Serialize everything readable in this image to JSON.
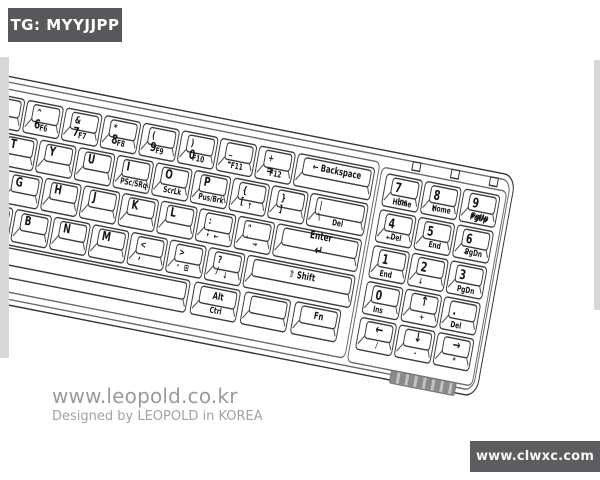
{
  "badge": {
    "text": "TG: MYYJJPP"
  },
  "watermark": {
    "line1": "www.leopold.co.kr",
    "line2": "Designed by LEOPOLD in KOREA"
  },
  "footer_badge": {
    "text": "www.clwxc.com"
  },
  "colors": {
    "badge_bg": "#58585a",
    "footer_bg": "#5d5d5f",
    "line": "#3c3c3c",
    "muted_text": "#9a9a9a"
  },
  "keyboard": {
    "main_keys": [
      {
        "id": "5",
        "x": 214,
        "y": 36,
        "w": 38,
        "h": 24,
        "label": "%\n5",
        "front": "F5",
        "cls": "num"
      },
      {
        "id": "6",
        "x": 254,
        "y": 36,
        "w": 38,
        "h": 24,
        "label": "^\n6",
        "front": "F6",
        "cls": "num"
      },
      {
        "id": "7",
        "x": 294,
        "y": 36,
        "w": 38,
        "h": 24,
        "label": "&\n7",
        "front": "F7",
        "cls": "num"
      },
      {
        "id": "8",
        "x": 334,
        "y": 36,
        "w": 38,
        "h": 24,
        "label": "*\n8",
        "front": "F8",
        "cls": "num"
      },
      {
        "id": "9",
        "x": 374,
        "y": 36,
        "w": 38,
        "h": 24,
        "label": "(\n9",
        "front": "F9",
        "cls": "num"
      },
      {
        "id": "0",
        "x": 414,
        "y": 36,
        "w": 38,
        "h": 24,
        "label": ")\n0",
        "front": "F10",
        "cls": "num"
      },
      {
        "id": "minus",
        "x": 454,
        "y": 36,
        "w": 38,
        "h": 24,
        "label": "_\n-",
        "front": "F11",
        "cls": "num"
      },
      {
        "id": "equals",
        "x": 494,
        "y": 36,
        "w": 38,
        "h": 24,
        "label": "+\n=",
        "front": "F12",
        "cls": "num"
      },
      {
        "id": "backspace",
        "x": 534,
        "y": 36,
        "w": 80,
        "h": 24,
        "label": "← Backspace",
        "cls": "mod"
      },
      {
        "id": "r",
        "x": 194,
        "y": 62,
        "w": 38,
        "h": 24,
        "label": "R",
        "cls": "ltr"
      },
      {
        "id": "t",
        "x": 234,
        "y": 62,
        "w": 38,
        "h": 24,
        "label": "T",
        "cls": "ltr"
      },
      {
        "id": "y",
        "x": 274,
        "y": 62,
        "w": 38,
        "h": 24,
        "label": "Y",
        "cls": "ltr"
      },
      {
        "id": "u",
        "x": 314,
        "y": 62,
        "w": 38,
        "h": 24,
        "label": "U",
        "cls": "ltr"
      },
      {
        "id": "i",
        "x": 354,
        "y": 62,
        "w": 38,
        "h": 24,
        "label": "I",
        "front": "PSc/SRq",
        "cls": "ltr"
      },
      {
        "id": "o",
        "x": 394,
        "y": 62,
        "w": 38,
        "h": 24,
        "label": "O",
        "front": "ScrLk",
        "cls": "ltr"
      },
      {
        "id": "p",
        "x": 434,
        "y": 62,
        "w": 38,
        "h": 24,
        "label": "P",
        "front": "Pus/Brk",
        "cls": "ltr"
      },
      {
        "id": "bracket-open",
        "x": 474,
        "y": 62,
        "w": 38,
        "h": 24,
        "label": "{\n[",
        "front": "↑",
        "cls": "sym"
      },
      {
        "id": "bracket-close",
        "x": 514,
        "y": 62,
        "w": 38,
        "h": 24,
        "label": "}\n]",
        "cls": "sym"
      },
      {
        "id": "backslash",
        "x": 554,
        "y": 62,
        "w": 60,
        "h": 24,
        "label": "|\n\\",
        "front": "Del",
        "cls": "sym"
      },
      {
        "id": "f",
        "x": 206,
        "y": 88,
        "w": 38,
        "h": 24,
        "label": "F",
        "cls": "ltr"
      },
      {
        "id": "g",
        "x": 246,
        "y": 88,
        "w": 38,
        "h": 24,
        "label": "G",
        "cls": "ltr"
      },
      {
        "id": "h",
        "x": 286,
        "y": 88,
        "w": 38,
        "h": 24,
        "label": "H",
        "cls": "ltr"
      },
      {
        "id": "j",
        "x": 326,
        "y": 88,
        "w": 38,
        "h": 24,
        "label": "J",
        "cls": "ltr"
      },
      {
        "id": "k",
        "x": 366,
        "y": 88,
        "w": 38,
        "h": 24,
        "label": "K",
        "cls": "ltr"
      },
      {
        "id": "l",
        "x": 406,
        "y": 88,
        "w": 38,
        "h": 24,
        "label": "L",
        "cls": "ltr"
      },
      {
        "id": "semicolon",
        "x": 446,
        "y": 88,
        "w": 38,
        "h": 24,
        "label": ":\n;",
        "front": "←",
        "cls": "sym"
      },
      {
        "id": "quote",
        "x": 486,
        "y": 88,
        "w": 38,
        "h": 24,
        "label": "\"\n'",
        "front": "→",
        "cls": "sym"
      },
      {
        "id": "enter",
        "x": 526,
        "y": 88,
        "w": 88,
        "h": 24,
        "label": "Enter\n↵",
        "cls": "enter"
      },
      {
        "id": "v",
        "x": 222,
        "y": 114,
        "w": 38,
        "h": 24,
        "label": "V",
        "cls": "ltr"
      },
      {
        "id": "b",
        "x": 262,
        "y": 114,
        "w": 38,
        "h": 24,
        "label": "B",
        "cls": "ltr"
      },
      {
        "id": "n",
        "x": 302,
        "y": 114,
        "w": 38,
        "h": 24,
        "label": "N",
        "cls": "ltr"
      },
      {
        "id": "m",
        "x": 342,
        "y": 114,
        "w": 38,
        "h": 24,
        "label": "M",
        "cls": "ltr"
      },
      {
        "id": "comma",
        "x": 382,
        "y": 114,
        "w": 38,
        "h": 24,
        "label": "<\n,",
        "cls": "sym"
      },
      {
        "id": "period",
        "x": 422,
        "y": 114,
        "w": 38,
        "h": 24,
        "label": ">\n.",
        "front": "⊞",
        "cls": "sym"
      },
      {
        "id": "slash",
        "x": 462,
        "y": 114,
        "w": 38,
        "h": 24,
        "label": "?\n/",
        "front": "↓",
        "cls": "sym"
      },
      {
        "id": "shift-right",
        "x": 502,
        "y": 114,
        "w": 112,
        "h": 24,
        "label": "⇧ Shift",
        "cls": "mod"
      },
      {
        "id": "space",
        "x": 166,
        "y": 140,
        "w": 284,
        "h": 24,
        "label": "",
        "cls": "mod"
      },
      {
        "id": "alt-right",
        "x": 454,
        "y": 140,
        "w": 48,
        "h": 24,
        "label": "Alt",
        "front": "Ctrl",
        "cls": "mod"
      },
      {
        "id": "blank",
        "x": 506,
        "y": 140,
        "w": 48,
        "h": 24,
        "label": "",
        "cls": "mod"
      },
      {
        "id": "fn",
        "x": 558,
        "y": 140,
        "w": 48,
        "h": 24,
        "label": "Fn",
        "cls": "mod"
      }
    ],
    "numpad_keys": [
      {
        "id": "np7",
        "x": 626,
        "y": 38,
        "w": 38,
        "h": 24,
        "label": "7\nHome",
        "front": "Ins",
        "cls": "np"
      },
      {
        "id": "np8",
        "x": 666,
        "y": 38,
        "w": 38,
        "h": 24,
        "label": "8\n↑",
        "front": "Home",
        "cls": "np"
      },
      {
        "id": "np9",
        "x": 706,
        "y": 38,
        "w": 38,
        "h": 24,
        "label": "9\nPgUp",
        "front": "PgUp",
        "cls": "np"
      },
      {
        "id": "np4",
        "x": 626,
        "y": 64,
        "w": 38,
        "h": 24,
        "label": "4\n←",
        "front": "Del",
        "cls": "np"
      },
      {
        "id": "np5",
        "x": 666,
        "y": 64,
        "w": 38,
        "h": 24,
        "label": "5",
        "front": "End",
        "cls": "np"
      },
      {
        "id": "np6",
        "x": 706,
        "y": 64,
        "w": 38,
        "h": 24,
        "label": "6\n→",
        "front": "PgDn",
        "cls": "np"
      },
      {
        "id": "np1",
        "x": 626,
        "y": 90,
        "w": 38,
        "h": 24,
        "label": "1\nEnd",
        "cls": "np"
      },
      {
        "id": "np2",
        "x": 666,
        "y": 90,
        "w": 38,
        "h": 24,
        "label": "2\n↓",
        "cls": "np"
      },
      {
        "id": "np3",
        "x": 706,
        "y": 90,
        "w": 38,
        "h": 24,
        "label": "3\nPgDn",
        "cls": "np"
      },
      {
        "id": "np0",
        "x": 626,
        "y": 116,
        "w": 38,
        "h": 24,
        "label": "0\nIns",
        "cls": "np"
      },
      {
        "id": "np-up",
        "x": 666,
        "y": 116,
        "w": 38,
        "h": 24,
        "label": "↑",
        "front": "+",
        "cls": "arr"
      },
      {
        "id": "np-dot",
        "x": 706,
        "y": 116,
        "w": 38,
        "h": 24,
        "label": ".\nDel",
        "cls": "np"
      },
      {
        "id": "np-left",
        "x": 626,
        "y": 142,
        "w": 38,
        "h": 24,
        "label": "←",
        "front": "/",
        "cls": "arr"
      },
      {
        "id": "np-down",
        "x": 666,
        "y": 142,
        "w": 38,
        "h": 24,
        "label": "↓",
        "front": "-",
        "cls": "arr"
      },
      {
        "id": "np-right",
        "x": 706,
        "y": 142,
        "w": 38,
        "h": 24,
        "label": "→",
        "front": "*",
        "cls": "arr"
      }
    ]
  }
}
